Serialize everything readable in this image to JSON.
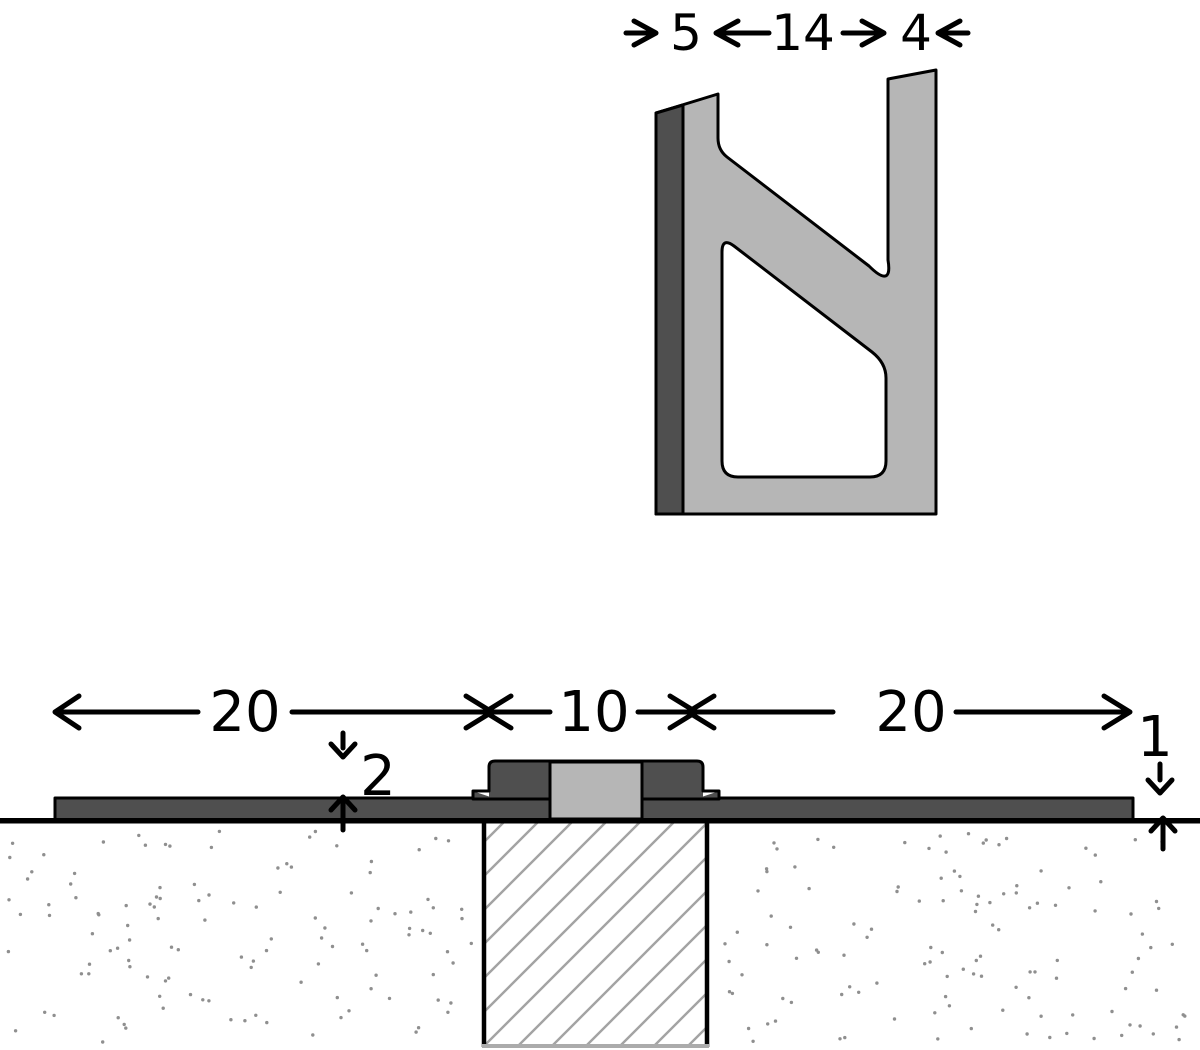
{
  "colors": {
    "outline": "#000000",
    "dark_gray": "#4f4f4f",
    "light_gray": "#b6b6b6",
    "hatch_line": "#a3a3a3",
    "stipple_dot": "#8f8f8f",
    "background": "#ffffff"
  },
  "profile_detail": {
    "dim_left_wall": "5",
    "dim_channel_gap": "14",
    "dim_right_wall": "4"
  },
  "section_view": {
    "dim_left_plate": "20",
    "dim_center_block": "10",
    "dim_right_plate": "20",
    "dim_step_height": "2",
    "dim_edge_thickness": "1"
  }
}
